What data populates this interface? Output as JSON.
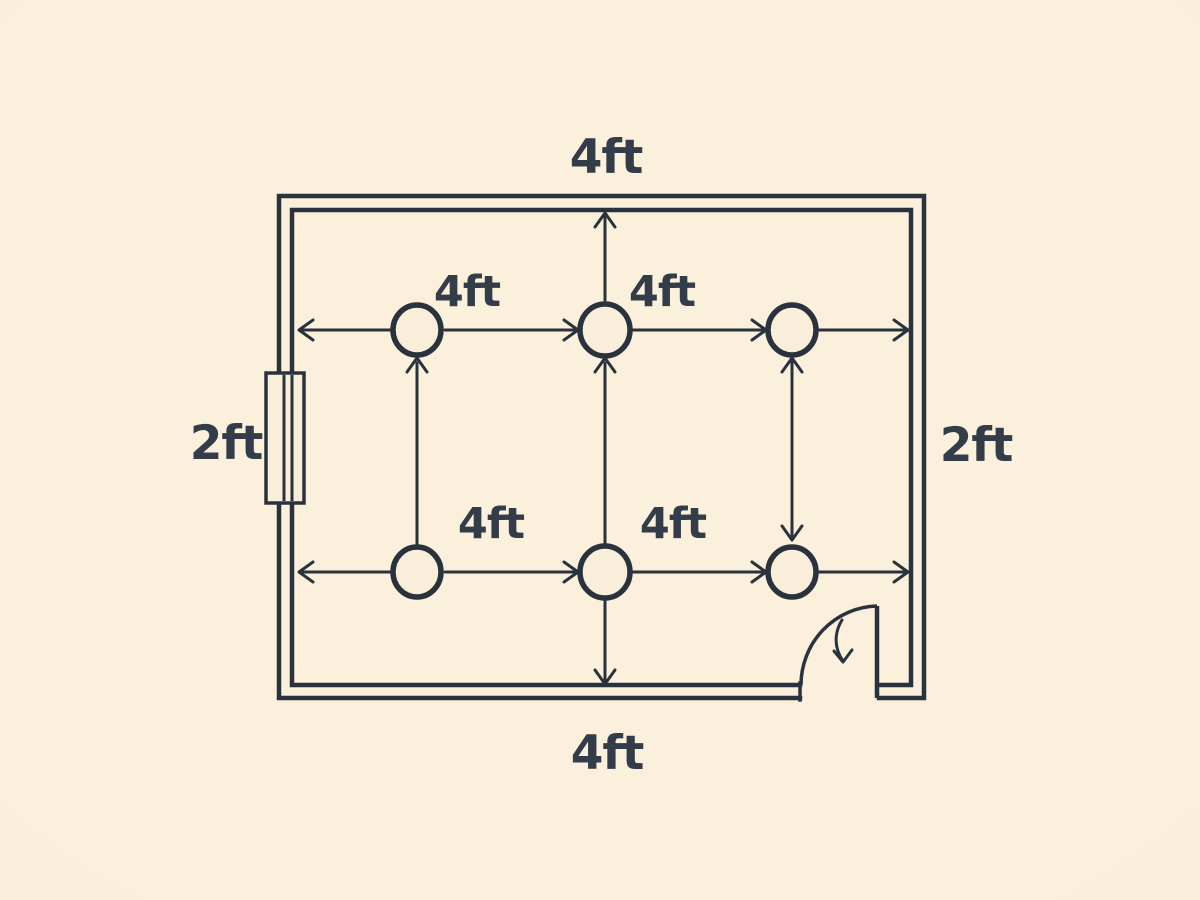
{
  "canvas": {
    "background": "#f9eed9",
    "vignette_edge": "#f0e1c6",
    "line_color": "#2a323d",
    "label_color": "#333c49"
  },
  "floor_plan": {
    "dimension_labels": {
      "top_wall": "4ft",
      "bottom_wall": "4ft",
      "left_wall": "2ft",
      "right_wall": "2ft"
    },
    "spacing_labels": {
      "row1_gap1": "4ft",
      "row1_gap2": "4ft",
      "row2_gap1": "4ft",
      "row2_gap2": "4ft"
    },
    "fixtures": {
      "rows": 2,
      "columns": 3,
      "total": 6,
      "symbol": "circle"
    },
    "features": {
      "window": "left-wall",
      "door": "bottom-right"
    }
  }
}
